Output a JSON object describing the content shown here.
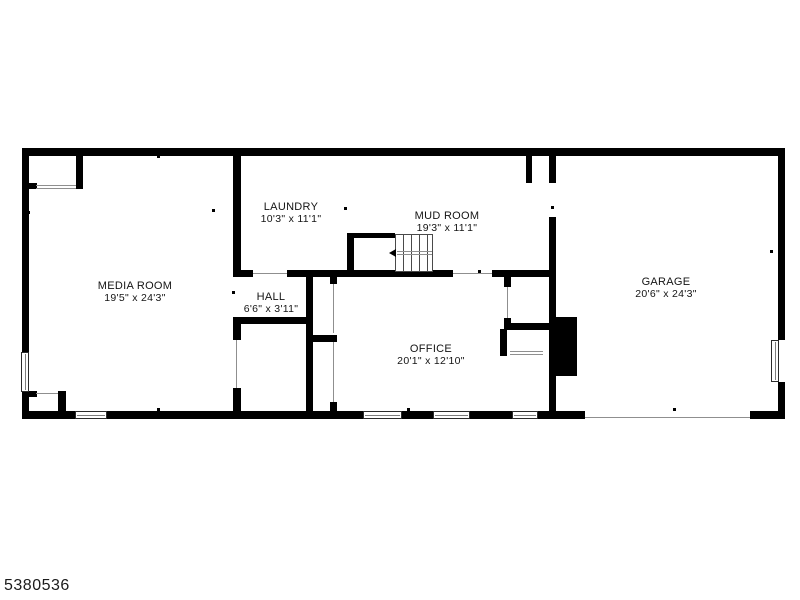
{
  "page": {
    "background": "#ffffff"
  },
  "footer": {
    "listing_id": "5380536"
  },
  "plan": {
    "wall_color": "#000000",
    "rooms": [
      {
        "name": "MEDIA ROOM",
        "dims": "19'5\" x 24'3\"",
        "cx": 135,
        "y": 280
      },
      {
        "name": "LAUNDRY",
        "dims": "10'3\" x 11'1\"",
        "cx": 291,
        "y": 201
      },
      {
        "name": "MUD ROOM",
        "dims": "19'3\" x 11'1\"",
        "cx": 447,
        "y": 210
      },
      {
        "name": "HALL",
        "dims": "6'6\" x 3'11\"",
        "cx": 271,
        "y": 291
      },
      {
        "name": "OFFICE",
        "dims": "20'1\" x 12'10\"",
        "cx": 431,
        "y": 343
      },
      {
        "name": "GARAGE",
        "dims": "20'6\" x 24'3\"",
        "cx": 666,
        "y": 276
      }
    ],
    "walls": [
      [
        22,
        148,
        763,
        8
      ],
      [
        22,
        148,
        7,
        204
      ],
      [
        22,
        392,
        7,
        27
      ],
      [
        778,
        148,
        7,
        192
      ],
      [
        778,
        382,
        7,
        37
      ],
      [
        22,
        411,
        53,
        8
      ],
      [
        107,
        411,
        256,
        8
      ],
      [
        402,
        411,
        31,
        8
      ],
      [
        470,
        411,
        42,
        8
      ],
      [
        538,
        411,
        47,
        8
      ],
      [
        750,
        411,
        35,
        8
      ],
      [
        76,
        156,
        7,
        33
      ],
      [
        29,
        183,
        8,
        6
      ],
      [
        58,
        391,
        8,
        21
      ],
      [
        29,
        391,
        8,
        6
      ],
      [
        233,
        156,
        8,
        116
      ],
      [
        233,
        317,
        80,
        7
      ],
      [
        233,
        318,
        8,
        22
      ],
      [
        233,
        388,
        8,
        24
      ],
      [
        233,
        270,
        20,
        7
      ],
      [
        287,
        270,
        166,
        7
      ],
      [
        492,
        270,
        64,
        7
      ],
      [
        306,
        272,
        7,
        140
      ],
      [
        330,
        277,
        7,
        7
      ],
      [
        306,
        335,
        31,
        7
      ],
      [
        330,
        402,
        7,
        10
      ],
      [
        347,
        233,
        7,
        39
      ],
      [
        347,
        233,
        48,
        5
      ],
      [
        526,
        156,
        6,
        27
      ],
      [
        549,
        156,
        7,
        27
      ],
      [
        549,
        217,
        7,
        101
      ],
      [
        549,
        376,
        7,
        36
      ],
      [
        504,
        277,
        7,
        10
      ],
      [
        504,
        318,
        7,
        11
      ],
      [
        504,
        323,
        45,
        7
      ],
      [
        500,
        329,
        7,
        27
      ]
    ],
    "chimney": [
      549,
      317,
      28,
      59
    ],
    "windows": [
      {
        "x": 21,
        "y": 352,
        "w": 8,
        "h": 40,
        "o": "v"
      },
      {
        "x": 75,
        "y": 411,
        "w": 32,
        "h": 8,
        "o": "h"
      },
      {
        "x": 363,
        "y": 411,
        "w": 39,
        "h": 8,
        "o": "h"
      },
      {
        "x": 433,
        "y": 411,
        "w": 37,
        "h": 8,
        "o": "h"
      },
      {
        "x": 512,
        "y": 411,
        "w": 26,
        "h": 8,
        "o": "h"
      },
      {
        "x": 771,
        "y": 340,
        "w": 8,
        "h": 42,
        "o": "v"
      }
    ],
    "thin_lines": [
      [
        36,
        185,
        40,
        1
      ],
      [
        36,
        188,
        40,
        1
      ],
      [
        36,
        393,
        22,
        1
      ],
      [
        236,
        340,
        1,
        48
      ],
      [
        333,
        284,
        1,
        49
      ],
      [
        333,
        342,
        1,
        60
      ],
      [
        507,
        287,
        1,
        31
      ],
      [
        510,
        351,
        33,
        1
      ],
      [
        510,
        354,
        33,
        1
      ],
      [
        585,
        417,
        165,
        1
      ],
      [
        253,
        273,
        34,
        1
      ],
      [
        453,
        273,
        39,
        1
      ]
    ],
    "ticks": [
      [
        157,
        155
      ],
      [
        482,
        152
      ],
      [
        673,
        152
      ],
      [
        157,
        408
      ],
      [
        407,
        408
      ],
      [
        673,
        408
      ],
      [
        27,
        211
      ],
      [
        770,
        250
      ],
      [
        212,
        209
      ],
      [
        344,
        207
      ],
      [
        551,
        206
      ],
      [
        478,
        270
      ],
      [
        232,
        291
      ]
    ],
    "stairs": {
      "x": 395,
      "y": 234,
      "w": 38,
      "h": 38,
      "treads": [
        7,
        15,
        23,
        31
      ],
      "rails": [
        [
          397,
          251,
          35,
          1
        ],
        [
          397,
          254,
          35,
          1
        ]
      ],
      "arrow": {
        "x": 389,
        "y": 249
      }
    }
  }
}
